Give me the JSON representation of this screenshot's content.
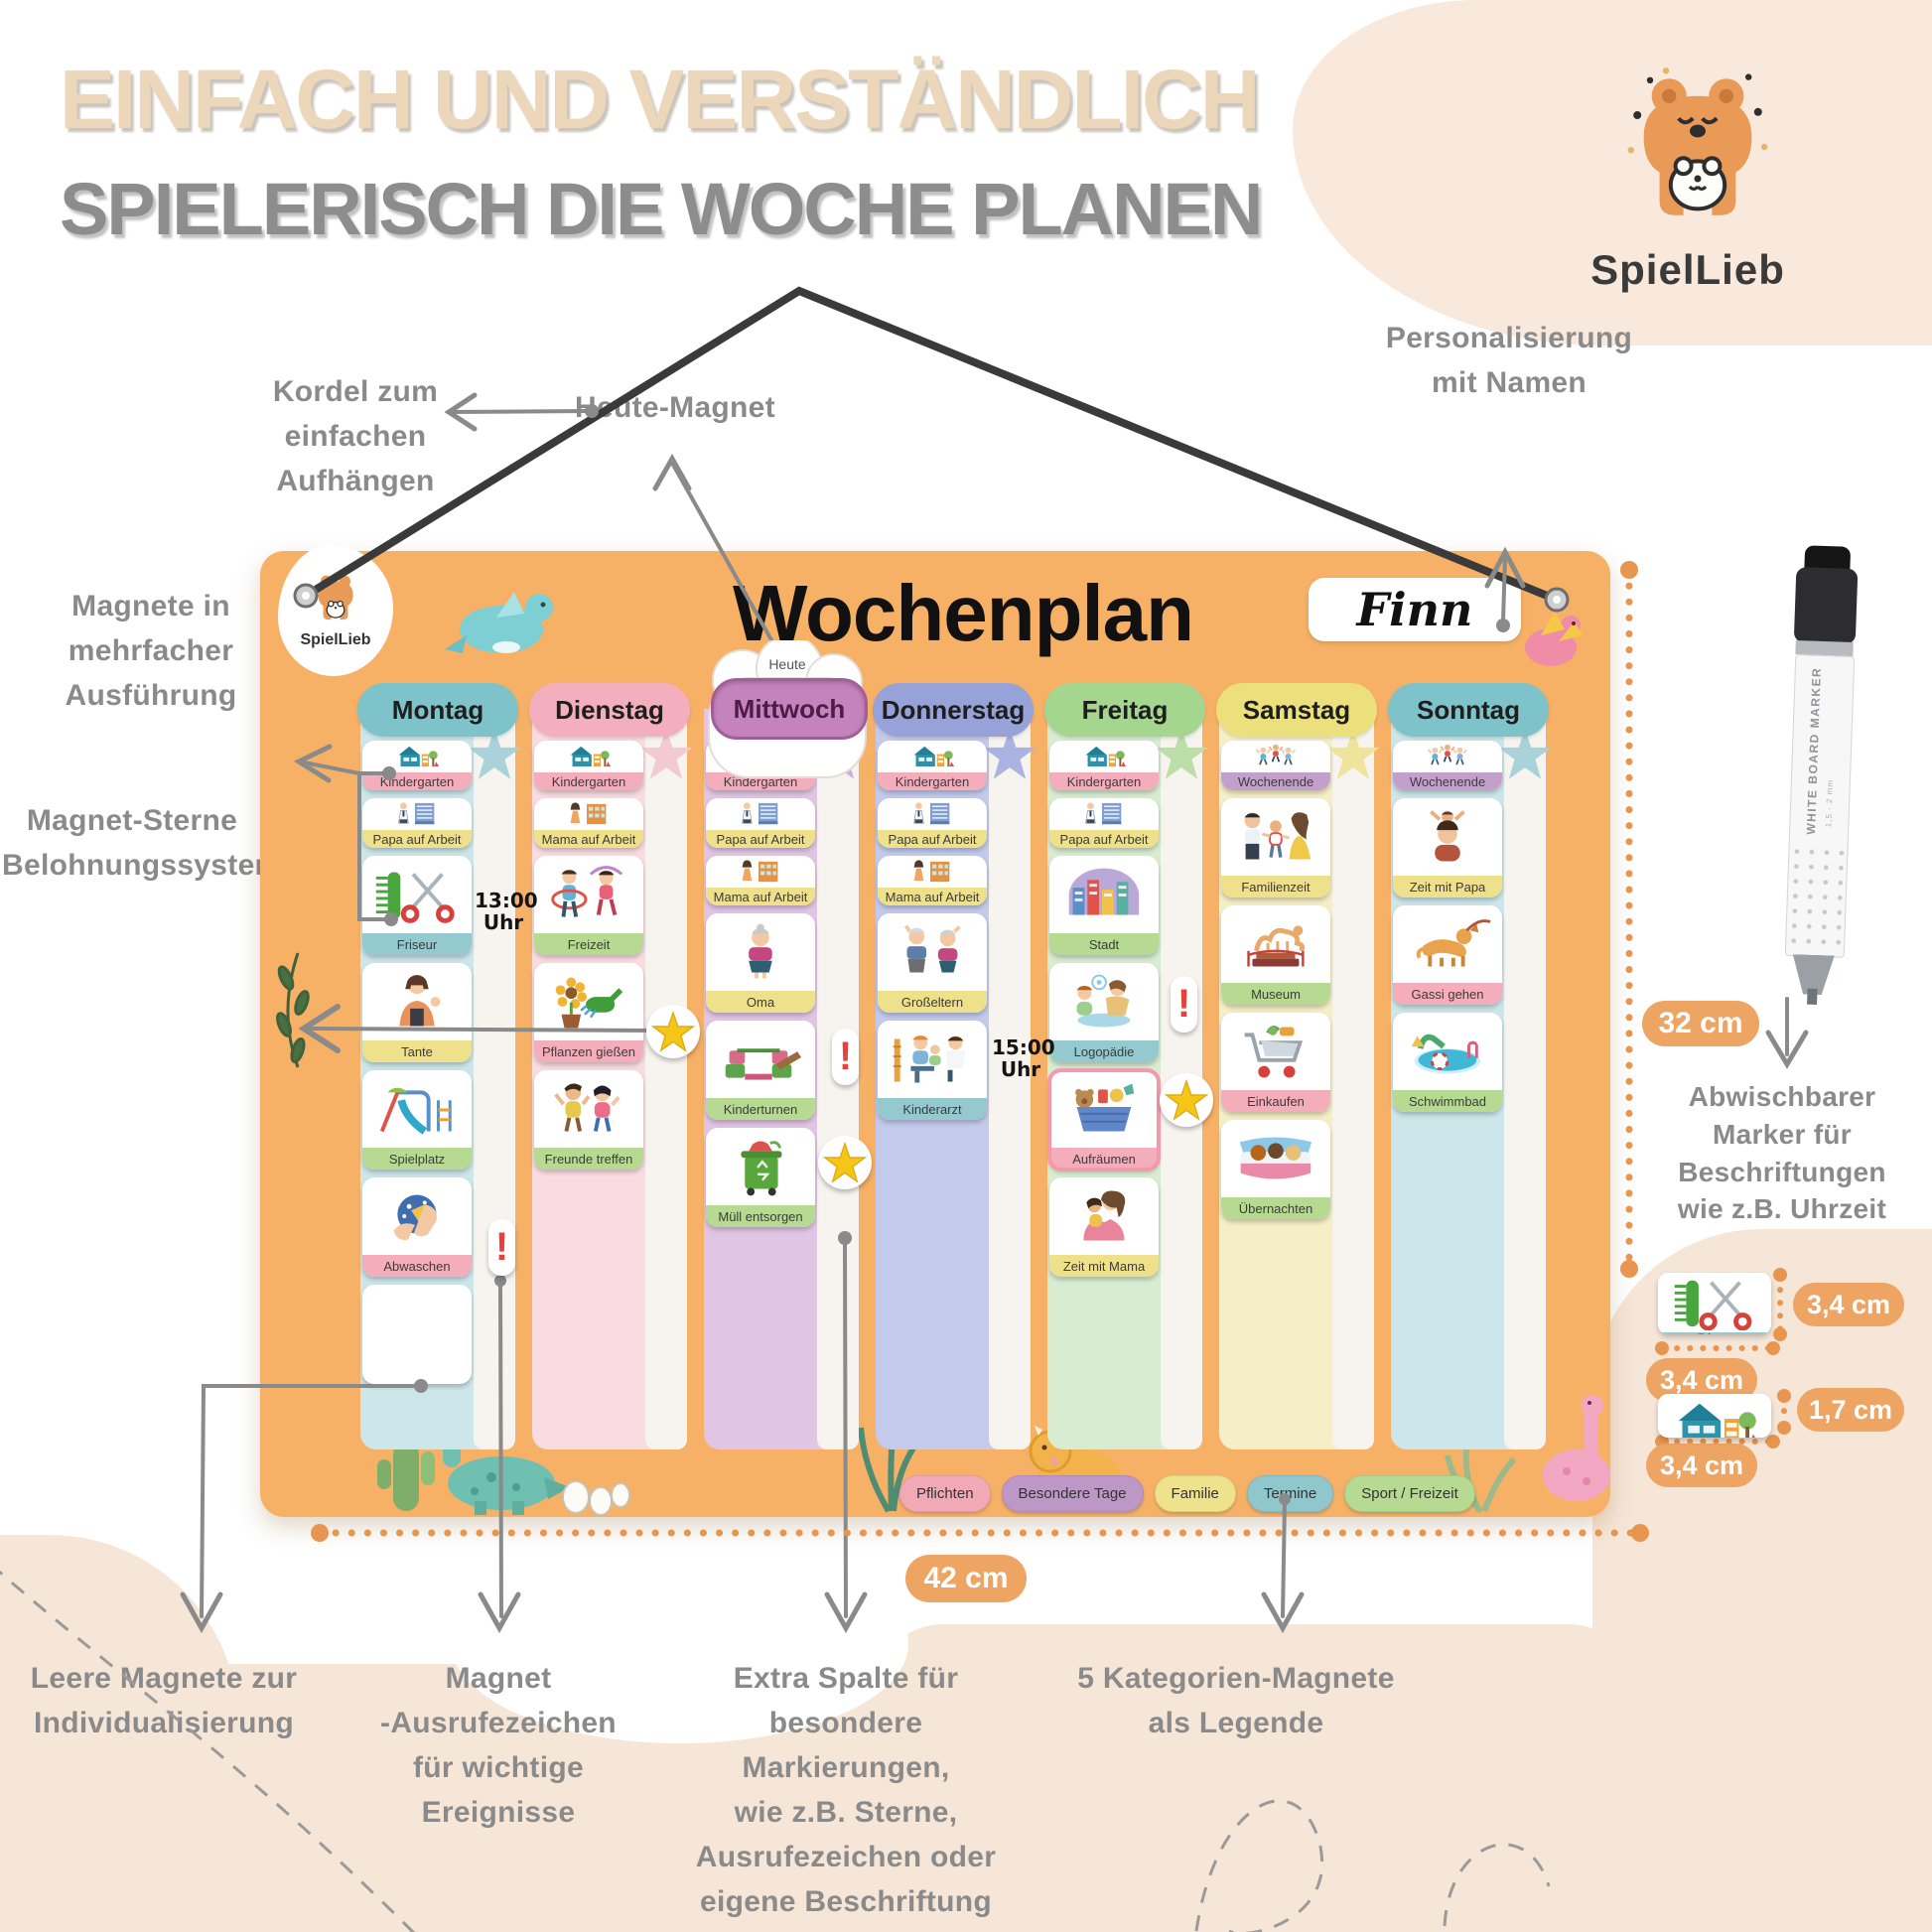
{
  "headline": {
    "line1": "EINFACH UND VERSTÄNDLICH",
    "line2": "SPIELERISCH DIE WOCHE PLANEN"
  },
  "brand": {
    "name": "SpielLieb"
  },
  "board": {
    "title": "Wochenplan",
    "name_tag": "Finn",
    "today_label": "Heute",
    "logo_text": "SpielLieb",
    "columns": [
      {
        "day": "Montag",
        "theme": "teal",
        "magnets": [
          {
            "label": "Kindergarten",
            "icon": "kindergarten",
            "label_color": "pink",
            "size": "sm"
          },
          {
            "label": "Papa auf Arbeit",
            "icon": "papa-work",
            "label_color": "yellow",
            "size": "sm"
          },
          {
            "label": "Friseur",
            "icon": "friseur",
            "label_color": "teal",
            "size": "lg"
          },
          {
            "label": "Tante",
            "icon": "tante",
            "label_color": "yellow",
            "size": "lg"
          },
          {
            "label": "Spielplatz",
            "icon": "spielplatz",
            "label_color": "green",
            "size": "lg"
          },
          {
            "label": "Abwaschen",
            "icon": "abwaschen",
            "label_color": "pink",
            "size": "lg"
          },
          {
            "label": "",
            "icon": "blank",
            "label_color": "white",
            "size": "lg"
          }
        ],
        "extras": [
          {
            "type": "time",
            "label": "13:00\nUhr"
          },
          {
            "type": "exclaim",
            "label": "!"
          }
        ]
      },
      {
        "day": "Dienstag",
        "theme": "pink",
        "magnets": [
          {
            "label": "Kindergarten",
            "icon": "kindergarten",
            "label_color": "pink",
            "size": "sm"
          },
          {
            "label": "Mama auf Arbeit",
            "icon": "mama-work",
            "label_color": "yellow",
            "size": "sm"
          },
          {
            "label": "Freizeit",
            "icon": "freizeit",
            "label_color": "green",
            "size": "lg"
          },
          {
            "label": "Pflanzen gießen",
            "icon": "pflanzen",
            "label_color": "pink",
            "size": "lg"
          },
          {
            "label": "Freunde treffen",
            "icon": "freunde",
            "label_color": "green",
            "size": "lg"
          }
        ],
        "extras": [
          {
            "type": "star"
          }
        ]
      },
      {
        "day": "Mittwoch",
        "theme": "purple",
        "today": true,
        "magnets": [
          {
            "label": "Kindergarten",
            "icon": "kindergarten",
            "label_color": "pink",
            "size": "sm"
          },
          {
            "label": "Papa auf Arbeit",
            "icon": "papa-work",
            "label_color": "yellow",
            "size": "sm"
          },
          {
            "label": "Mama auf Arbeit",
            "icon": "mama-work",
            "label_color": "yellow",
            "size": "sm"
          },
          {
            "label": "Oma",
            "icon": "oma",
            "label_color": "yellow",
            "size": "lg"
          },
          {
            "label": "Kinderturnen",
            "icon": "kinderturnen",
            "label_color": "green",
            "size": "lg"
          },
          {
            "label": "Müll entsorgen",
            "icon": "muell",
            "label_color": "green",
            "size": "lg"
          }
        ],
        "extras": [
          {
            "type": "exclaim",
            "label": "!"
          },
          {
            "type": "star"
          }
        ]
      },
      {
        "day": "Donnerstag",
        "theme": "blue",
        "magnets": [
          {
            "label": "Kindergarten",
            "icon": "kindergarten",
            "label_color": "pink",
            "size": "sm"
          },
          {
            "label": "Papa auf Arbeit",
            "icon": "papa-work",
            "label_color": "yellow",
            "size": "sm"
          },
          {
            "label": "Mama auf Arbeit",
            "icon": "mama-work",
            "label_color": "yellow",
            "size": "sm"
          },
          {
            "label": "Großeltern",
            "icon": "grosseltern",
            "label_color": "yellow",
            "size": "lg"
          },
          {
            "label": "Kinderarzt",
            "icon": "kinderarzt",
            "label_color": "teal",
            "size": "lg"
          }
        ],
        "extras": [
          {
            "type": "time",
            "label": "15:00\nUhr"
          }
        ]
      },
      {
        "day": "Freitag",
        "theme": "green",
        "magnets": [
          {
            "label": "Kindergarten",
            "icon": "kindergarten",
            "label_color": "pink",
            "size": "sm"
          },
          {
            "label": "Papa auf Arbeit",
            "icon": "papa-work",
            "label_color": "yellow",
            "size": "sm"
          },
          {
            "label": "Stadt",
            "icon": "stadt",
            "label_color": "green",
            "size": "lg"
          },
          {
            "label": "Logopädie",
            "icon": "logopaedie",
            "label_color": "teal",
            "size": "lg"
          },
          {
            "label": "Aufräumen",
            "icon": "aufraeumen",
            "label_color": "pink",
            "size": "lg",
            "highlight": true
          },
          {
            "label": "Zeit mit Mama",
            "icon": "zeit-mama",
            "label_color": "yellow",
            "size": "lg"
          }
        ],
        "extras": [
          {
            "type": "exclaim",
            "label": "!"
          },
          {
            "type": "star"
          }
        ]
      },
      {
        "day": "Samstag",
        "theme": "yellow",
        "magnets": [
          {
            "label": "Wochenende",
            "icon": "wochenende",
            "label_color": "purple",
            "size": "sm"
          },
          {
            "label": "Familienzeit",
            "icon": "familienzeit",
            "label_color": "yellow",
            "size": "lg"
          },
          {
            "label": "Museum",
            "icon": "museum",
            "label_color": "green",
            "size": "lg"
          },
          {
            "label": "Einkaufen",
            "icon": "einkaufen",
            "label_color": "pink",
            "size": "lg"
          },
          {
            "label": "Übernachten",
            "icon": "uebernachten",
            "label_color": "green",
            "size": "lg"
          }
        ],
        "extras": []
      },
      {
        "day": "Sonntag",
        "theme": "teal",
        "magnets": [
          {
            "label": "Wochenende",
            "icon": "wochenende",
            "label_color": "purple",
            "size": "sm"
          },
          {
            "label": "Zeit mit Papa",
            "icon": "zeit-papa",
            "label_color": "yellow",
            "size": "lg"
          },
          {
            "label": "Gassi gehen",
            "icon": "gassi",
            "label_color": "pink",
            "size": "lg"
          },
          {
            "label": "Schwimmbad",
            "icon": "schwimmbad",
            "label_color": "green",
            "size": "lg"
          }
        ],
        "extras": []
      }
    ],
    "legend": [
      {
        "label": "Pflichten",
        "color": "pink"
      },
      {
        "label": "Besondere Tage",
        "color": "purple"
      },
      {
        "label": "Familie",
        "color": "yellow"
      },
      {
        "label": "Termine",
        "color": "teal"
      },
      {
        "label": "Sport / Freizeit",
        "color": "green"
      }
    ]
  },
  "annotations": {
    "kordel": "Kordel zum\neinfachen Aufhängen",
    "heute": "Heute-Magnet",
    "personalisierung": "Personalisierung\nmit Namen",
    "magnete_mehrfach": "Magnete in\nmehrfacher\nAusführung",
    "sterne": "Magnet-Sterne\nBelohnungssystem",
    "leere": "Leere Magnete zur\nIndividualisierung",
    "ausrufezeichen": "Magnet\n-Ausrufezeichen\nfür wichtige\nEreignisse",
    "extra_spalte": "Extra Spalte für\nbesondere Markierungen,\nwie z.B. Sterne,\nAusrufezeichen oder\neigene Beschriftung",
    "kategorien": "5 Kategorien-Magnete\nals Legende",
    "marker": "Abwischbarer\nMarker für\nBeschriftungen\nwie z.B. Uhrzeit"
  },
  "measurements": {
    "board_width": "42 cm",
    "board_height": "32 cm",
    "sample1_height": "3,4 cm",
    "sample1_width": "3,4 cm",
    "sample2_height": "1,7 cm",
    "sample2_width": "3,4 cm"
  },
  "marker": {
    "label": "WHITE BOARD MARKER",
    "sub": "1,5 - 2 mm"
  },
  "samples": [
    {
      "label": "Friseur",
      "icon": "friseur",
      "label_color": "teal"
    },
    {
      "label": "Kindergarten",
      "icon": "kindergarten",
      "label_color": "pink"
    }
  ]
}
